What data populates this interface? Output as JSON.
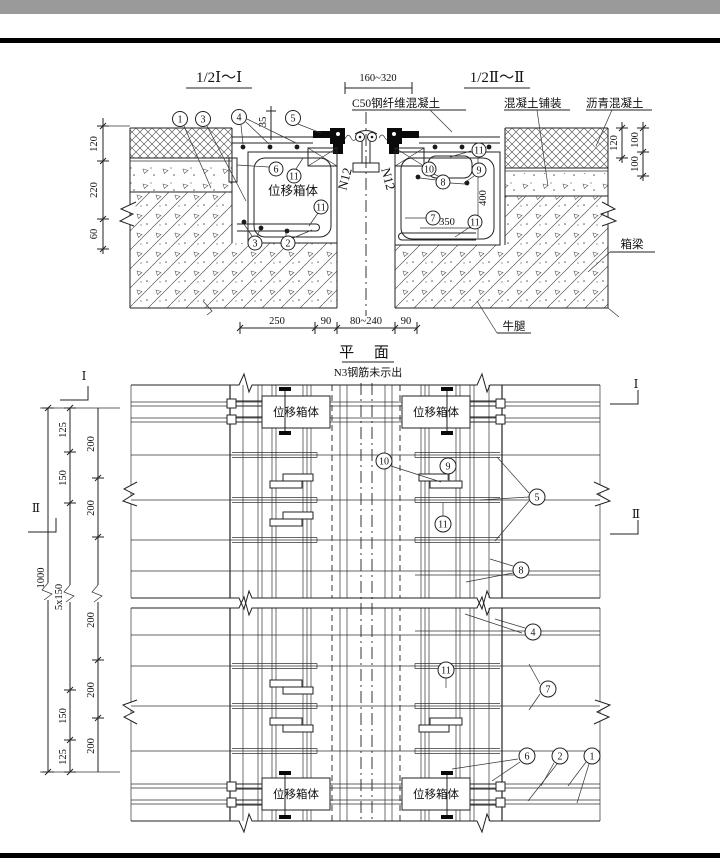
{
  "colors": {
    "top_bar": "#9a9a9a",
    "rule": "#000000",
    "line": "#222222",
    "paper": "#ffffff"
  },
  "shared": {
    "displacement_box": "位移箱体"
  },
  "xsec": {
    "title_left": "1/2Ⅰ～Ⅰ",
    "title_right": "1/2Ⅱ～Ⅱ",
    "gap_dim": "160~320",
    "label_c50": "C50钢纤维混凝土",
    "label_paving": "混凝土铺装",
    "label_asphalt": "沥青混凝土",
    "label_box_girder": "箱梁",
    "label_corbel": "牛腿",
    "rebar_n12": "N12",
    "dim_plate": "35",
    "dim_box_h": "400",
    "dim_box_w": "350",
    "dims_left": [
      "120",
      "220",
      "60"
    ],
    "dims_right_a": [
      "120"
    ],
    "dims_right_b": [
      "100",
      "100"
    ],
    "dims_bottom": [
      "250",
      "90",
      "80~240",
      "90"
    ]
  },
  "plan": {
    "title": "平 面",
    "subtitle": "N3钢筋未示出",
    "mark_I": "Ⅰ",
    "mark_II": "Ⅱ",
    "dim_overall": "1000",
    "chain_a": [
      "125",
      "150",
      "5x150",
      "150",
      "125"
    ],
    "chain_b": [
      "200",
      "200",
      "200",
      "200",
      "200"
    ]
  },
  "callouts": {
    "xsec_left": [
      "1",
      "3",
      "4",
      "5"
    ],
    "xsec_box": [
      "6",
      "11",
      "11",
      "3",
      "2"
    ],
    "xsec_right": [
      "11",
      "10",
      "9",
      "8",
      "7",
      "11"
    ],
    "plan_upper": [
      "10",
      "9",
      "5",
      "11",
      "8"
    ],
    "plan_lower": [
      "4",
      "11",
      "7",
      "6",
      "2",
      "1"
    ]
  }
}
